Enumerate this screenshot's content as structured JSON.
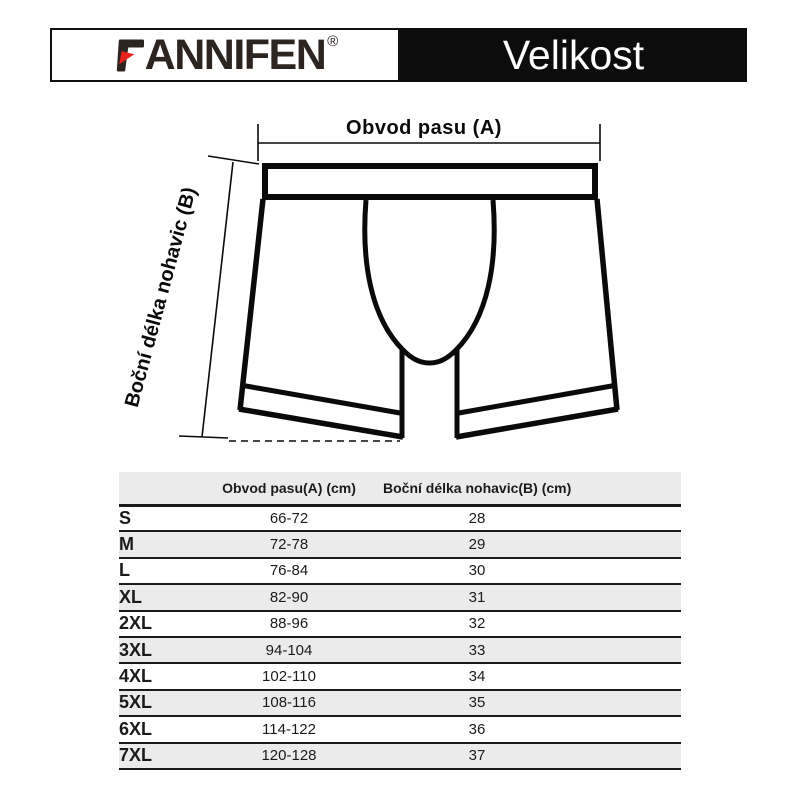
{
  "header": {
    "brand": "FANNIFEN",
    "brand_rest": "ANNIFEN",
    "registered": "®",
    "title": "Velikost",
    "title_bg": "#0c0c0c",
    "logo_color": "#2b2421",
    "logo_accent_red": "#e7231d"
  },
  "diagram": {
    "waist_label": "Obvod pasu (A)",
    "length_label": "Boční délka nohavic (B)"
  },
  "size_table": {
    "columns": [
      "",
      "Obvod pasu(A) (cm)",
      "Boční délka nohavic(B) (cm)"
    ],
    "row_stripe_color": "#ebebeb",
    "rows": [
      {
        "size": "S",
        "waist": "66-72",
        "length": "28"
      },
      {
        "size": "M",
        "waist": "72-78",
        "length": "29"
      },
      {
        "size": "L",
        "waist": "76-84",
        "length": "30"
      },
      {
        "size": "XL",
        "waist": "82-90",
        "length": "31"
      },
      {
        "size": "2XL",
        "waist": "88-96",
        "length": "32"
      },
      {
        "size": "3XL",
        "waist": "94-104",
        "length": "33"
      },
      {
        "size": "4XL",
        "waist": "102-110",
        "length": "34"
      },
      {
        "size": "5XL",
        "waist": "108-116",
        "length": "35"
      },
      {
        "size": "6XL",
        "waist": "114-122",
        "length": "36"
      },
      {
        "size": "7XL",
        "waist": "120-128",
        "length": "37"
      }
    ]
  }
}
